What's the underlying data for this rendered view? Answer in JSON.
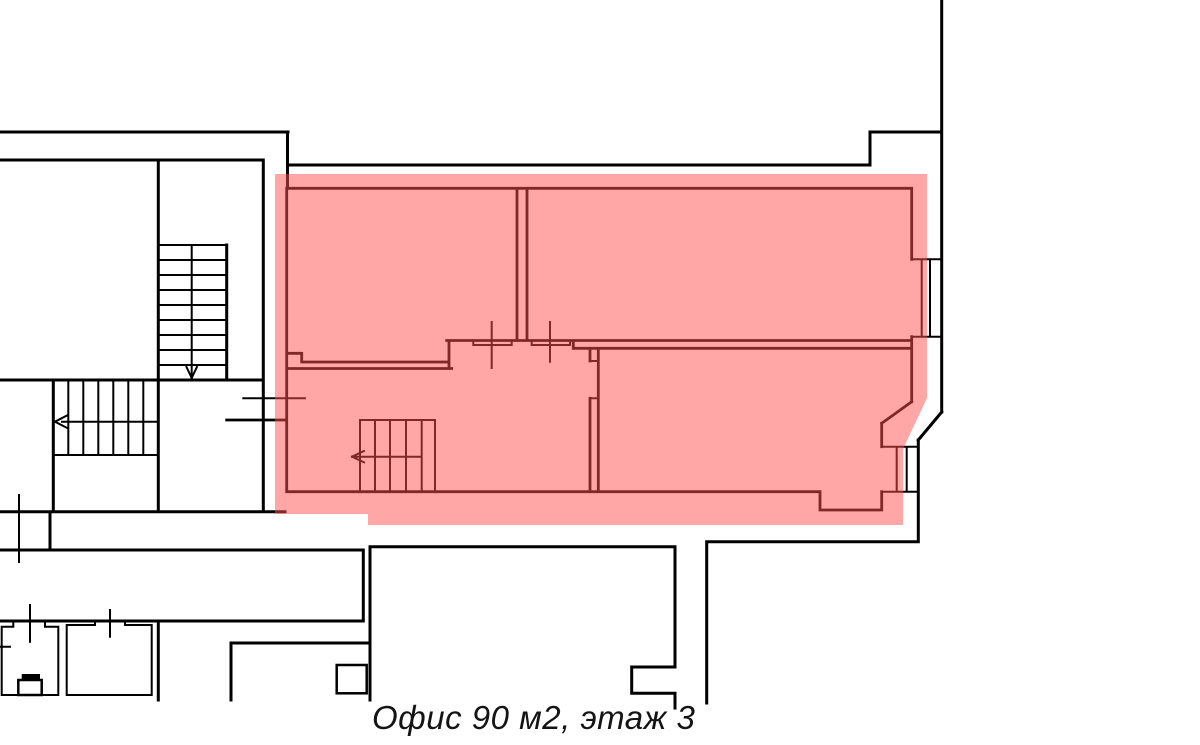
{
  "caption": {
    "text": "Офис 90 м2, этаж 3"
  },
  "highlight": {
    "name": "office-highlight",
    "fill": "#FF5050",
    "opacity": 0.5,
    "points": "275,174 927,174 927,398 903,449 903,525 368,525 368,514 275,514"
  },
  "floorplan": {
    "width": 1200,
    "height": 745,
    "background": "#ffffff",
    "stroke_color": "#000000",
    "layers": [
      {
        "name": "building-outline-walls",
        "stroke": "#000000",
        "stroke_width": 3,
        "segments": [
          [
            0,
            132,
            288,
            132
          ],
          [
            287.5,
            132,
            287.5,
            188
          ],
          [
            288,
            165,
            870,
            165
          ],
          [
            870,
            132,
            870,
            165
          ],
          [
            870,
            132,
            941.7,
            132
          ],
          [
            941.7,
            0,
            941.7,
            412
          ],
          [
            941.7,
            412,
            918.3,
            440
          ],
          [
            918.3,
            440,
            918.3,
            541.7
          ],
          [
            706.7,
            541.7,
            918.3,
            541.7
          ],
          [
            706.7,
            541.7,
            706.7,
            703
          ],
          [
            0,
            160,
            263.3,
            160
          ],
          [
            158.3,
            160,
            158.3,
            380
          ],
          [
            263.3,
            160,
            263.3,
            511.7
          ],
          [
            226.7,
            245,
            226.7,
            380
          ],
          [
            0,
            380,
            263.3,
            380
          ],
          [
            53.3,
            380,
            53.3,
            511.7
          ],
          [
            158.3,
            380,
            158.3,
            511.7
          ],
          [
            0,
            511.7,
            285,
            511.7
          ],
          [
            0,
            550,
            363.3,
            550
          ],
          [
            50,
            511.7,
            50,
            550
          ],
          [
            363.3,
            550,
            363.3,
            621
          ],
          [
            0,
            621,
            363.3,
            621
          ],
          [
            158.3,
            621,
            158.3,
            700
          ],
          [
            370,
            546.7,
            675,
            546.7
          ],
          [
            370,
            546.7,
            370,
            700
          ],
          [
            231,
            643,
            370,
            643
          ],
          [
            231,
            643,
            231,
            700
          ],
          [
            675,
            546.7,
            675,
            667
          ],
          [
            631.7,
            667,
            675,
            667
          ],
          [
            631.7,
            667,
            631.7,
            693.3
          ],
          [
            631.7,
            693.3,
            675,
            693.3
          ],
          [
            675,
            693.3,
            675,
            708
          ]
        ]
      },
      {
        "name": "building-details-windows-stairs",
        "stroke": "#000000",
        "stroke_width": 2,
        "segments": [
          [
            911.7,
            259.3,
            941.7,
            259.3
          ],
          [
            911.7,
            336.7,
            941.7,
            336.7
          ],
          [
            921.7,
            259.3,
            921.7,
            336.7
          ],
          [
            930,
            259.3,
            930,
            336.7
          ],
          [
            881.7,
            446.7,
            918.3,
            446.7
          ],
          [
            881.7,
            491.7,
            918.3,
            491.7
          ],
          [
            896.7,
            446.7,
            896.7,
            491.7
          ],
          [
            906.7,
            446.7,
            906.7,
            491.7
          ],
          [
            158.3,
            245,
            226.7,
            245
          ],
          [
            158.3,
            260,
            226.7,
            260
          ],
          [
            158.3,
            275,
            226.7,
            275
          ],
          [
            158.3,
            290,
            226.7,
            290
          ],
          [
            158.3,
            305,
            226.7,
            305
          ],
          [
            158.3,
            320,
            226.7,
            320
          ],
          [
            158.3,
            335,
            226.7,
            335
          ],
          [
            158.3,
            350,
            226.7,
            350
          ],
          [
            158.3,
            365,
            226.7,
            365
          ],
          [
            191.7,
            245,
            191.7,
            375
          ],
          [
            186.5,
            367,
            191.7,
            378
          ],
          [
            196.9,
            367,
            191.7,
            378
          ],
          [
            68.3,
            381.7,
            68.3,
            455
          ],
          [
            83.3,
            381.7,
            83.3,
            455
          ],
          [
            98.3,
            381.7,
            98.3,
            455
          ],
          [
            113.3,
            381.7,
            113.3,
            455
          ],
          [
            128.3,
            381.7,
            128.3,
            455
          ],
          [
            143.3,
            381.7,
            143.3,
            455
          ],
          [
            53.3,
            455,
            158.3,
            455
          ],
          [
            62,
            421.7,
            158.3,
            421.7
          ],
          [
            67,
            415.5,
            55,
            421.7
          ],
          [
            67,
            427.9,
            55,
            421.7
          ],
          [
            19,
            495,
            19,
            562
          ],
          [
            1.7,
            626.7,
            13.3,
            626.7
          ],
          [
            45,
            626.7,
            58.3,
            626.7
          ],
          [
            13.3,
            621,
            13.3,
            626.7
          ],
          [
            45,
            621,
            45,
            626.7
          ],
          [
            1.7,
            626.7,
            1.7,
            695
          ],
          [
            58.3,
            626.7,
            58.3,
            695
          ],
          [
            1.7,
            695,
            58.3,
            695
          ],
          [
            30,
            605,
            30,
            641.7
          ],
          [
            0,
            646.7,
            10,
            646.7
          ],
          [
            66.7,
            625,
            95,
            625
          ],
          [
            125,
            625,
            151.7,
            625
          ],
          [
            95,
            621,
            95,
            625
          ],
          [
            125,
            621,
            125,
            625
          ],
          [
            66.7,
            625,
            66.7,
            695
          ],
          [
            151.7,
            625,
            151.7,
            695
          ],
          [
            66.7,
            695,
            151.7,
            695
          ],
          [
            110,
            610,
            110,
            636.7
          ]
        ]
      },
      {
        "name": "office-walls",
        "stroke": "#000000",
        "stroke_width": 2.8,
        "segments": [
          [
            286.7,
            188.3,
            911.7,
            188.3
          ],
          [
            286.7,
            188.3,
            286.7,
            491.7
          ],
          [
            286.7,
            353.3,
            301.7,
            353.3
          ],
          [
            301.7,
            353.3,
            301.7,
            362
          ],
          [
            301.7,
            362,
            446.7,
            362
          ],
          [
            286.7,
            368.5,
            451.7,
            368.5
          ],
          [
            449,
            340.5,
            449,
            368.5
          ],
          [
            446.7,
            340.5,
            911.7,
            340.5
          ],
          [
            573.3,
            348.3,
            911.7,
            348.3
          ],
          [
            573.3,
            340.5,
            573.3,
            348.3
          ],
          [
            517,
            188.3,
            517,
            340.5
          ],
          [
            527,
            188.3,
            527,
            340.5
          ],
          [
            590,
            348.3,
            590,
            361
          ],
          [
            590,
            398.3,
            590,
            491.7
          ],
          [
            598.3,
            348.3,
            598.3,
            491.7
          ],
          [
            286.7,
            491.7,
            820,
            491.7
          ],
          [
            820,
            491.7,
            820,
            510
          ],
          [
            820,
            510,
            881.7,
            510
          ],
          [
            911.7,
            188.3,
            911.7,
            259.3
          ],
          [
            911.7,
            336.7,
            911.7,
            401.7
          ],
          [
            911.7,
            401.7,
            881.7,
            423.3
          ],
          [
            881.7,
            423.3,
            881.7,
            446.7
          ],
          [
            881.7,
            491.7,
            881.7,
            510
          ],
          [
            226.7,
            420,
            286.7,
            420
          ]
        ]
      },
      {
        "name": "office-details-doors-stairs",
        "stroke": "#000000",
        "stroke_width": 2,
        "segments": [
          [
            243.3,
            398.3,
            305,
            398.3
          ],
          [
            473.3,
            345,
            511.7,
            345
          ],
          [
            531.7,
            345,
            570,
            345
          ],
          [
            473.3,
            340.5,
            473.3,
            345
          ],
          [
            511.7,
            340.5,
            511.7,
            345
          ],
          [
            531.7,
            340.5,
            531.7,
            345
          ],
          [
            570,
            340.5,
            570,
            345
          ],
          [
            491.7,
            322,
            491.7,
            368
          ],
          [
            550,
            322,
            550,
            361.7
          ],
          [
            590,
            361,
            598.3,
            361
          ],
          [
            590,
            398.3,
            598.3,
            398.3
          ],
          [
            360,
            420,
            435,
            420
          ],
          [
            360,
            420,
            360,
            491.7
          ],
          [
            375,
            420,
            375,
            491.7
          ],
          [
            390,
            420,
            390,
            491.7
          ],
          [
            406,
            420,
            406,
            491.7
          ],
          [
            421.7,
            420,
            421.7,
            491.7
          ],
          [
            435,
            420,
            435,
            491.7
          ],
          [
            352,
            456.7,
            421.7,
            456.7
          ],
          [
            364,
            451,
            352,
            456.7
          ],
          [
            364,
            462.4,
            352,
            456.7
          ]
        ]
      }
    ],
    "rects": [
      {
        "name": "toilet-tank",
        "x": 21.7,
        "y": 674,
        "w": 18.3,
        "h": 6,
        "fill": "#000000",
        "stroke": "none",
        "stroke_width": 0
      },
      {
        "name": "toilet-bowl",
        "x": 18.3,
        "y": 680,
        "w": 23.4,
        "h": 15,
        "fill": "none",
        "stroke": "#000000",
        "stroke_width": 2.5
      },
      {
        "name": "column-block",
        "x": 336.7,
        "y": 665,
        "w": 30,
        "h": 28.3,
        "fill": "none",
        "stroke": "#000000",
        "stroke_width": 2.5
      }
    ]
  }
}
